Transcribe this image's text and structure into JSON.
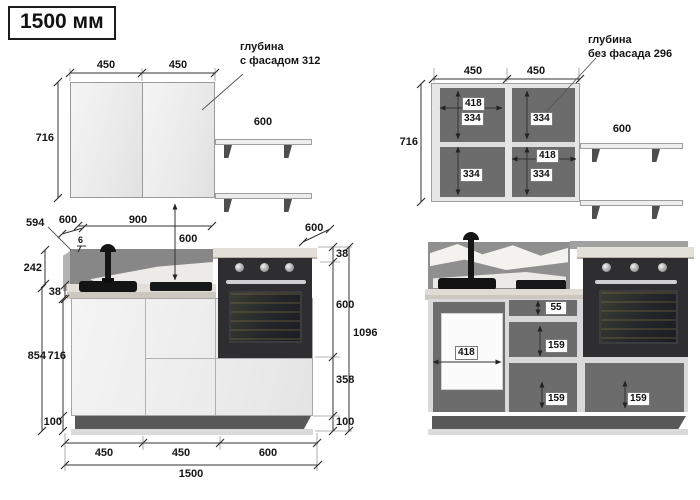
{
  "title": "1500 мм",
  "upper_facade": {
    "width_left": "450",
    "width_right": "450",
    "height": "716",
    "shelf_width": "600",
    "depth_note": [
      "глубина",
      "с фасадом 312"
    ]
  },
  "upper_open": {
    "width_left": "450",
    "width_right": "450",
    "height": "716",
    "shelf_width": "600",
    "depth_note": [
      "глубина",
      "без фасада 296"
    ],
    "left_inner_width": "418",
    "left_top_height": "334",
    "left_bottom_height": "334",
    "right_top_height": "334",
    "right_inner_width": "418",
    "right_bottom_height": "334"
  },
  "lower_facade": {
    "corner_depth": "594",
    "top_depth": "600",
    "panel_thickness": "6",
    "span": "900",
    "wall_gap": "600",
    "splash_height": "242",
    "counter_thickness_left": "38",
    "height_with_counter": "854",
    "box_height": "716",
    "plinth_left": "100",
    "right_depth": "600",
    "counter_thickness_right": "38",
    "oven_height": "600",
    "drawer_height": "358",
    "plinth_right": "100",
    "total_height": "1096",
    "bottom_w1": "450",
    "bottom_w2": "450",
    "bottom_w3": "600",
    "total_width": "1500"
  },
  "lower_open": {
    "opening_width": "418",
    "top_drawer": "55",
    "mid_drawer": "159",
    "bottom_drawer": "159",
    "right_drawer": "159"
  }
}
